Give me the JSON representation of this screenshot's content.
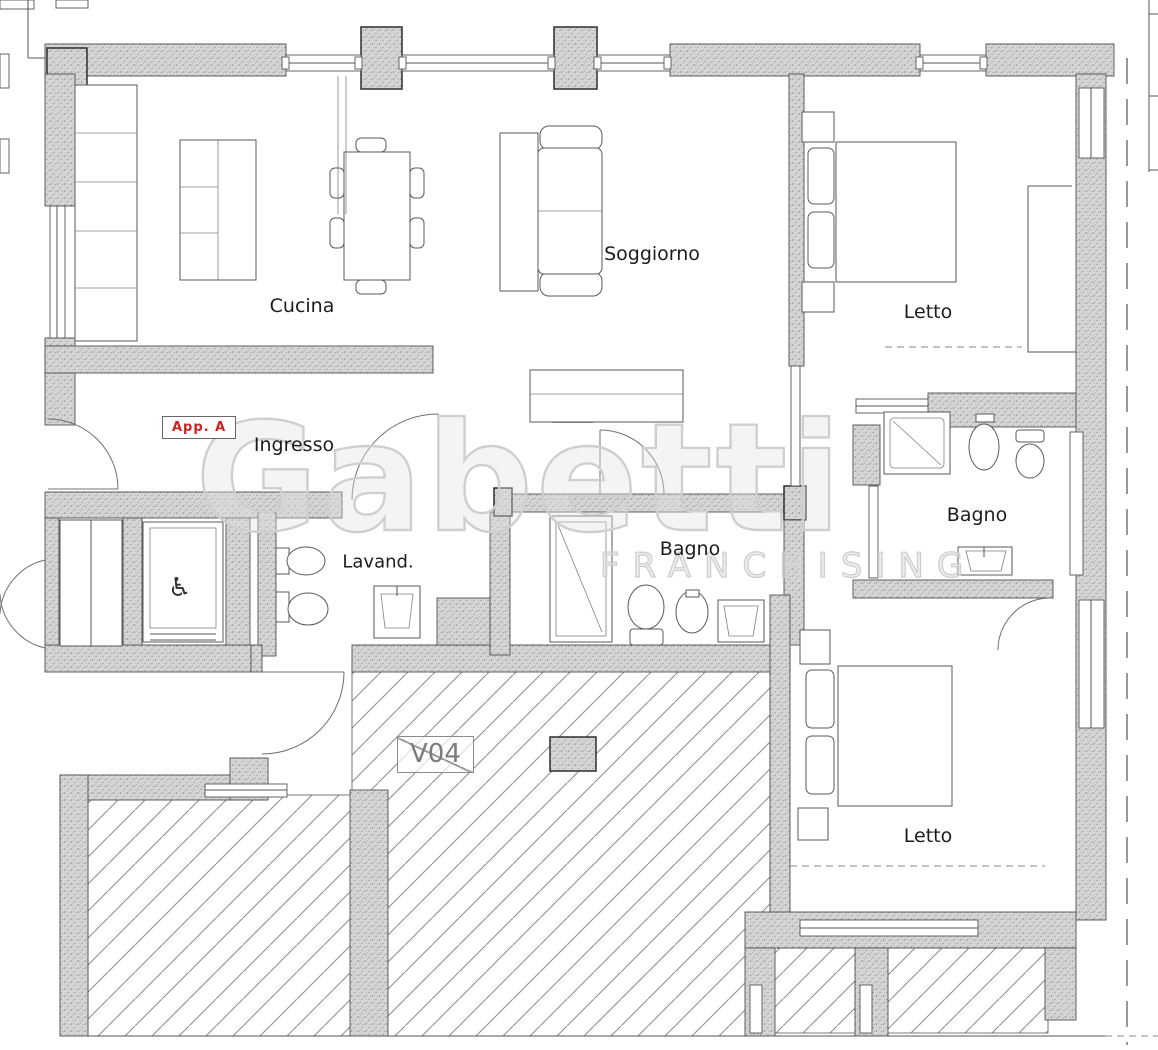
{
  "plan": {
    "unit_label": "App. A",
    "terrace_code": "V04",
    "rooms": [
      {
        "id": "ingresso",
        "name": "Ingresso"
      },
      {
        "id": "cucina",
        "name": "Cucina"
      },
      {
        "id": "soggiorno",
        "name": "Soggiorno"
      },
      {
        "id": "letto-1",
        "name": "Letto"
      },
      {
        "id": "bagno-1",
        "name": "Bagno"
      },
      {
        "id": "lavanderia",
        "name": "Lavand."
      },
      {
        "id": "bagno-2",
        "name": "Bagno"
      },
      {
        "id": "letto-2",
        "name": "Letto"
      }
    ],
    "icons": {
      "wheelchair": "♿"
    },
    "watermark": {
      "brand": "Gabetti",
      "subtitle": "FRANCHISING"
    },
    "colors": {
      "background": "#ffffff",
      "wall_fill": "#d6d6d6",
      "line": "#4f4f4f",
      "unit_label_text": "#cc2222",
      "watermark": "#cfcfcf",
      "hatch_line": "#8f8f8f"
    }
  }
}
